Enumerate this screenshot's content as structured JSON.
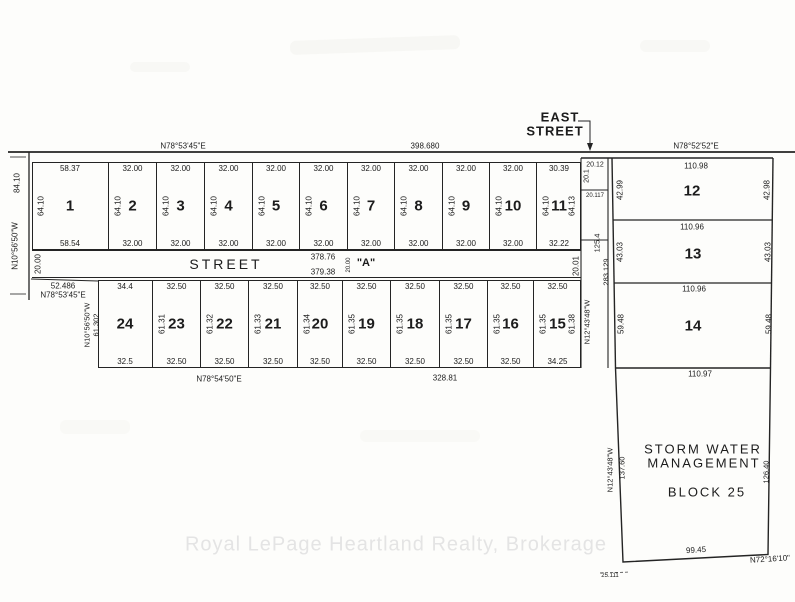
{
  "plan": {
    "watermark": "Royal LePage Heartland Realty, Brokerage",
    "east_street": {
      "line1": "EAST",
      "line2": "STREET"
    },
    "north_boundary": {
      "bearing_west": "N78°53'45\"E",
      "total": "398.680",
      "bearing_east": "N78°52'52\"E"
    },
    "west_boundary": {
      "dim": "84.10",
      "bearing": "N10°56'50\"W"
    },
    "street_a": {
      "name": "STREET",
      "letter": "\"A\"",
      "north_length": "378.76",
      "south_length": "379.38",
      "width_west": "20.00",
      "width_mid": "20.00",
      "width_east": "20.01"
    },
    "top_row": {
      "lots": [
        {
          "num": "1",
          "top": "58.37",
          "bottom": "58.54",
          "side": "64.10"
        },
        {
          "num": "2",
          "top": "32.00",
          "bottom": "32.00",
          "side": "64.10"
        },
        {
          "num": "3",
          "top": "32.00",
          "bottom": "32.00",
          "side": "64.10"
        },
        {
          "num": "4",
          "top": "32.00",
          "bottom": "32.00",
          "side": "64.10"
        },
        {
          "num": "5",
          "top": "32.00",
          "bottom": "32.00",
          "side": "64.10"
        },
        {
          "num": "6",
          "top": "32.00",
          "bottom": "32.00",
          "side": "64.10"
        },
        {
          "num": "7",
          "top": "32.00",
          "bottom": "32.00",
          "side": "64.10"
        },
        {
          "num": "8",
          "top": "32.00",
          "bottom": "32.00",
          "side": "64.10"
        },
        {
          "num": "9",
          "top": "32.00",
          "bottom": "32.00",
          "side": "64.10"
        },
        {
          "num": "10",
          "top": "32.00",
          "bottom": "32.00",
          "side": "64.10"
        },
        {
          "num": "11",
          "top": "30.39",
          "bottom": "32.22",
          "side": "64.10",
          "side_right": "64.13"
        }
      ]
    },
    "bottom_row": {
      "lots": [
        {
          "num": "24",
          "top": "34.4",
          "bottom": "32.5"
        },
        {
          "num": "23",
          "top": "32.50",
          "bottom": "32.50",
          "side": "61.31"
        },
        {
          "num": "22",
          "top": "32.50",
          "bottom": "32.50",
          "side": "61.32"
        },
        {
          "num": "21",
          "top": "32.50",
          "bottom": "32.50",
          "side": "61.33"
        },
        {
          "num": "20",
          "top": "32.50",
          "bottom": "32.50",
          "side": "61.34"
        },
        {
          "num": "19",
          "top": "32.50",
          "bottom": "32.50",
          "side": "61.35"
        },
        {
          "num": "18",
          "top": "32.50",
          "bottom": "32.50",
          "side": "61.35"
        },
        {
          "num": "17",
          "top": "32.50",
          "bottom": "32.50",
          "side": "61.35"
        },
        {
          "num": "16",
          "top": "32.50",
          "bottom": "32.50",
          "side": "61.35"
        },
        {
          "num": "15",
          "top": "32.50",
          "bottom": "34.25",
          "side": "61.35",
          "side_right": "61.38"
        }
      ],
      "west_bearing": "N10°56'50\"W",
      "west_dim": "61.302",
      "nw_dim": "52.486",
      "nw_bearing": "N78°53'45\"E",
      "south_bearing": "N78°54'50\"E",
      "south_total": "328.81",
      "east_bearing": "N12°43'48\"W"
    },
    "east_block": {
      "lots": [
        {
          "num": "12",
          "top": "110.98",
          "left": "42.99",
          "right": "42.98"
        },
        {
          "num": "13",
          "top": "110.96",
          "left": "43.03",
          "right": "43.03"
        },
        {
          "num": "14",
          "top": "110.96",
          "left": "59.48",
          "right": "59.48",
          "bottom": "110.97"
        }
      ],
      "west_total": "283.129"
    },
    "reserve_parcels": {
      "p1_top": "20.12",
      "p1_side": "20.1",
      "p2_dim": "20.117",
      "strip_length": "125.4"
    },
    "block25": {
      "name_line1": "STORM WATER",
      "name_line2": "MANAGEMENT",
      "name_line3": "BLOCK 25",
      "west_bearing": "N12°43'48\"W",
      "west_dim": "137.60",
      "east_dim": "126.40",
      "south_dim": "99.45",
      "south_bearing": "N72°16'10\"",
      "corner_note": "25.111"
    }
  }
}
